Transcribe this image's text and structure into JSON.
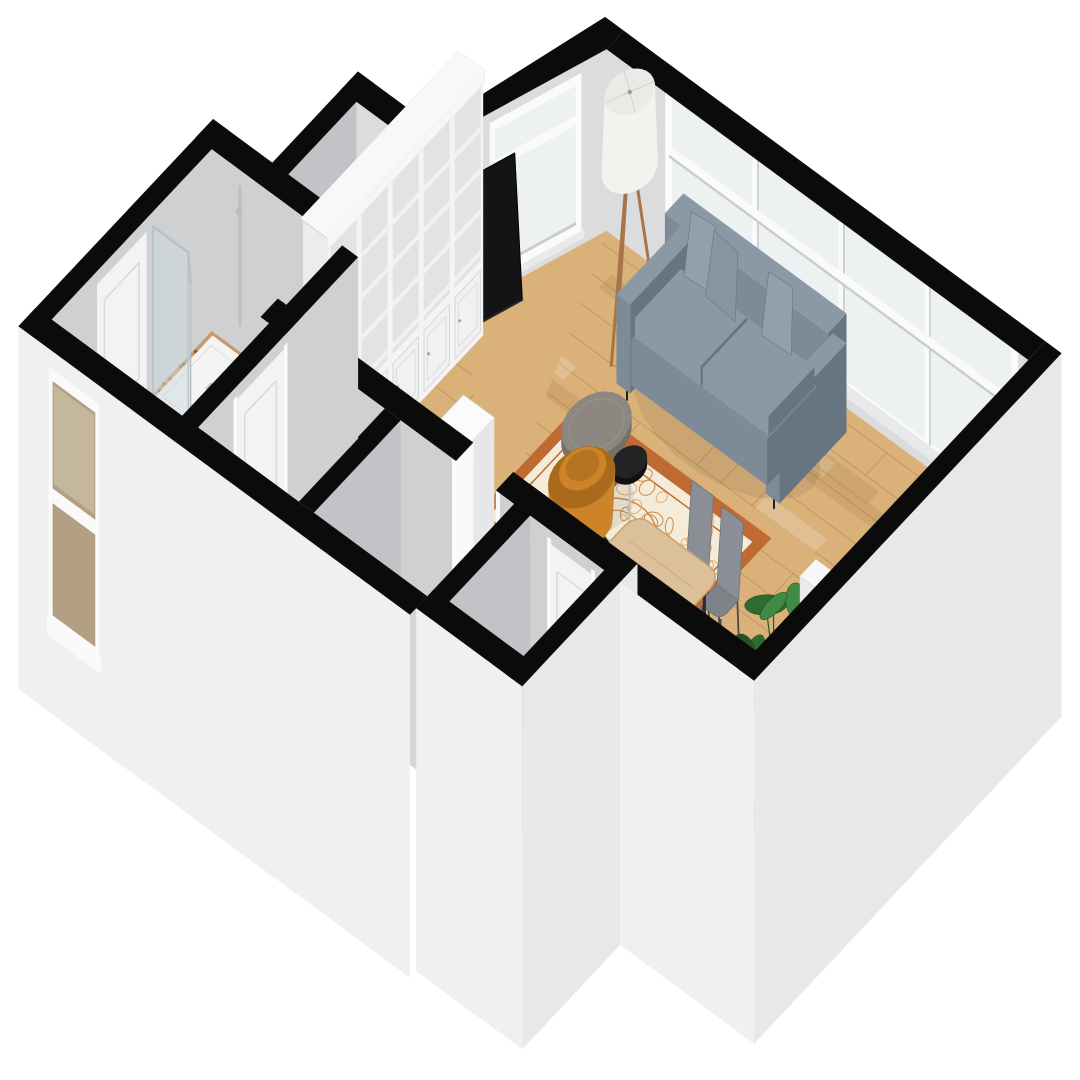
{
  "title": "Isometric 3D floor plan render of a studio apartment with living room, bathroom, hallways and entry vestibule",
  "background": "#ffffff",
  "palette": {
    "wallTop": "#0b0b0b",
    "wallInt": "#cfd0d2",
    "wallIntLight": "#dbdcde",
    "wallIntDark": "#c2c3c6",
    "wallExt": "#f0f0f1",
    "wallExtShade": "#e8e8ea",
    "frame": "#fafafa",
    "frameShade": "#c9cdd0",
    "sill": "#e7e9ea",
    "glass": "#edf1f2",
    "glassTint": "rgba(205,218,223,0.5)",
    "floorWood": "#d9b179",
    "woodSeam": "rgba(150,106,53,0.35)",
    "woodStreakL": "rgba(255,255,255,0.20)",
    "woodStreakD": "rgba(151,103,48,0.16)",
    "grayFloor": "#d5d6d9",
    "grayFloor2": "#d9d9db",
    "terrazzo": "#c79a6b",
    "terrazzoDots": [
      "#8a6844",
      "#5f4a33",
      "#e8d0a6",
      "#a87c4f",
      "#7a5c3e"
    ],
    "rugField": "#f4ecd9",
    "rugBorder": "#bf6a33",
    "rugInner": "#d0884a",
    "rugPat": "#e3ad6e",
    "sofa": "#7d8b98",
    "sofaLight": "#8b99a6",
    "sofaDark": "#677582",
    "pillow": "#93a0ac",
    "pillowD": "#8794a1",
    "tableTop": "#8d8781",
    "chrome": "#b9bfc2",
    "chairOrange": "#cd8429",
    "chairOrangeDark": "#a96a1c",
    "chairSeat": "#b5731f",
    "chairGray": "#7e838a",
    "chairGrayL": "#8a8f96",
    "dwood": "#dcc09a",
    "dwoodEdge": "#c3a276",
    "lampLeg": "#a9744a",
    "door": "#f3f3f4",
    "doorTrim": "#d9d9dc",
    "showerTray": "#f4f4f2",
    "green1": "#2f6b2f",
    "green2": "#418a43",
    "green3": "#24541f",
    "stemGreen": "#2c5a28",
    "legDark": "#222224"
  },
  "scene": {
    "rooms": [
      {
        "name": "living-room",
        "floor": "wood"
      },
      {
        "name": "bathroom",
        "floor": "terrazzo"
      },
      {
        "name": "hallway-a",
        "floor": "gray"
      },
      {
        "name": "hallway-b",
        "floor": "gray"
      },
      {
        "name": "entry-vestibule",
        "floor": "gray"
      },
      {
        "name": "closet-nook",
        "floor": "gray"
      }
    ],
    "furniture": [
      "bookshelf-wall-unit",
      "flat-tv",
      "tripod-floor-lamp",
      "gray-sofa",
      "throw-pillows",
      "oriental-rug",
      "round-coffee-table",
      "black-side-table",
      "orange-armchair",
      "dining-table",
      "dining-chair",
      "dining-chair",
      "monstera-plant",
      "staircase",
      "white-cabinet",
      "walk-in-shower",
      "toilet"
    ],
    "windows": [
      "panoramic-window-band",
      "tall-transom-window",
      "bathroom-sash-window"
    ],
    "doors": [
      "entry-door",
      "bathroom-door",
      "side-room-door",
      "living-room-doorway"
    ]
  },
  "geometry": {
    "basis": {
      "ux": [
        57,
        42
      ],
      "uy": [
        -62,
        66
      ],
      "uz": 165,
      "wallH": 1.1,
      "slabZ": -1.1
    },
    "living": {
      "floor": [
        [
          0,
          0
        ],
        [
          7.4,
          0
        ],
        [
          7.4,
          4.4
        ],
        [
          -0.7,
          4.4
        ],
        [
          -0.7,
          1.6
        ]
      ]
    },
    "chamfer": {
      "a": [
        0,
        0
      ],
      "k": [
        -0.7,
        1.6
      ],
      "top": [
        [
          0,
          0
        ],
        [
          -0.7,
          1.6
        ],
        [
          -0.98,
          1.6
        ],
        [
          -0.33,
          -0.28
        ],
        [
          0,
          -0.28
        ]
      ]
    },
    "backWall": {
      "x0": 0,
      "x1": 7.4,
      "win": {
        "x0": 1.1,
        "x1": 7.15,
        "sill": 0.14,
        "transom": 0.74,
        "mullions": [
          2.61,
          4.12,
          5.63
        ]
      }
    },
    "bath": {
      "floor": [
        -3.12,
        3.5,
        -0.83,
        6.08
      ],
      "window": {
        "x0": -2.8,
        "x1": -2.05,
        "z0": -0.5,
        "z1": 0.92
      }
    },
    "hallA": [
      -0.55,
      4.68,
      1.2,
      6.08
    ],
    "hallB": [
      1.48,
      4.68,
      3.47,
      6.08
    ],
    "vestFloor": [
      3.75,
      4.68,
      5.05,
      5.98
    ],
    "closetFloor": [
      -2.08,
      2.12,
      -0.98,
      3.22
    ],
    "furn": {
      "bookshelf": {
        "x0": -0.7,
        "x1": -0.26,
        "y0": 1.75,
        "y1": 4.25,
        "h": 1.62,
        "cab": 0.44,
        "cols": 5
      },
      "lamp": {
        "c": [
          1.3,
          0.82
        ]
      },
      "sofa": {
        "x0": 1.72,
        "x1": 4.58,
        "y0": 0.34,
        "y1": 1.42
      },
      "rug": {
        "x0": 1.42,
        "y0": 1.68,
        "x1": 4.72,
        "y1": 3.52
      },
      "ctable": {
        "c": [
          2.52,
          2.48
        ],
        "r": 0.42
      },
      "stable": {
        "c": [
          3.34,
          2.7
        ],
        "r": 0.21
      },
      "armchair": {
        "c": [
          2.98,
          3.14
        ]
      },
      "dtable": [
        4.25,
        3.42,
        5.75,
        4.32
      ],
      "dchairs": [
        [
          4.95,
          3.2
        ],
        [
          5.52,
          3.24
        ]
      ],
      "plant": {
        "c": [
          6.22,
          3.02
        ]
      },
      "stairs": {
        "x0": 6.72,
        "x1": 7.4,
        "yStart": 4.1,
        "depth": 0.26,
        "steps": 5,
        "rise": 0.17
      },
      "cabinet": [
        1.82,
        3.98,
        2.36,
        4.36
      ]
    }
  }
}
